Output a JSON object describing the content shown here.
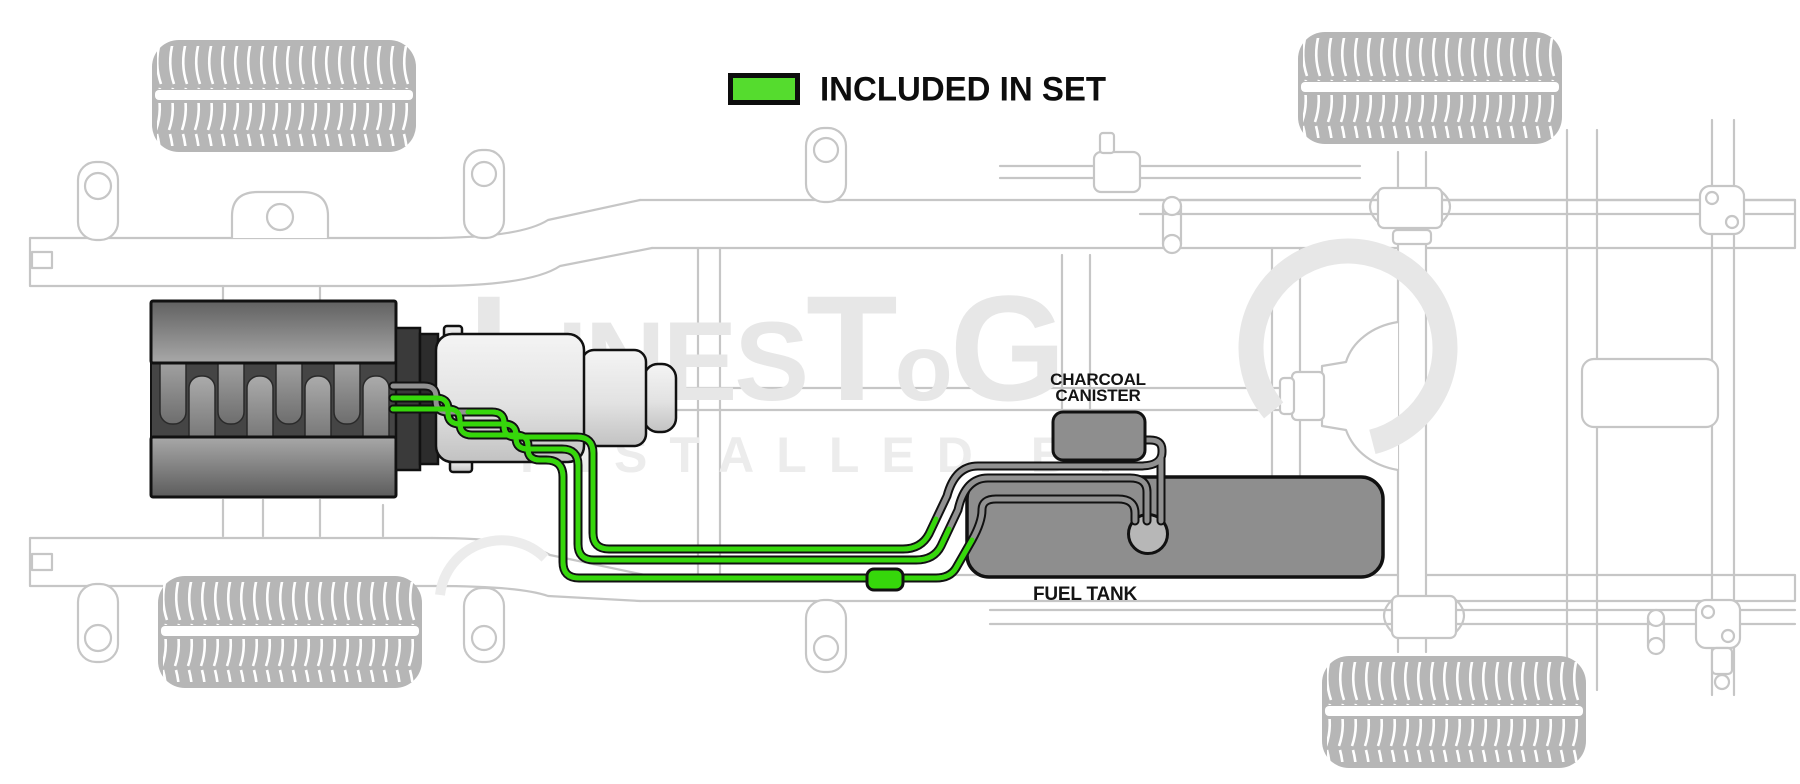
{
  "legend": {
    "label": "INCLUDED IN SET",
    "swatch_color": "#55dc2e"
  },
  "labels": {
    "charcoal_canister": {
      "line1": "CHARCOAL",
      "line2": "CANISTER"
    },
    "fuel_tank": "FUEL TANK"
  },
  "watermark": {
    "part1": "L",
    "part2": "INES",
    "part3": "T",
    "part4": "o",
    "part5": "G",
    "line2": "INSTALLED BY"
  },
  "colors": {
    "included_line_green": "#36d70b",
    "legend_swatch_green": "#55dc2e",
    "excluded_line_gray": "#919191",
    "line_casing_black": "#111111",
    "chassis_outline_gray": "#c6c6c6",
    "component_gray": "#8e8e8e",
    "pump_module_gray": "#b7b7b7",
    "watermark_gray": "#e7e7e7",
    "background": "#ffffff"
  }
}
